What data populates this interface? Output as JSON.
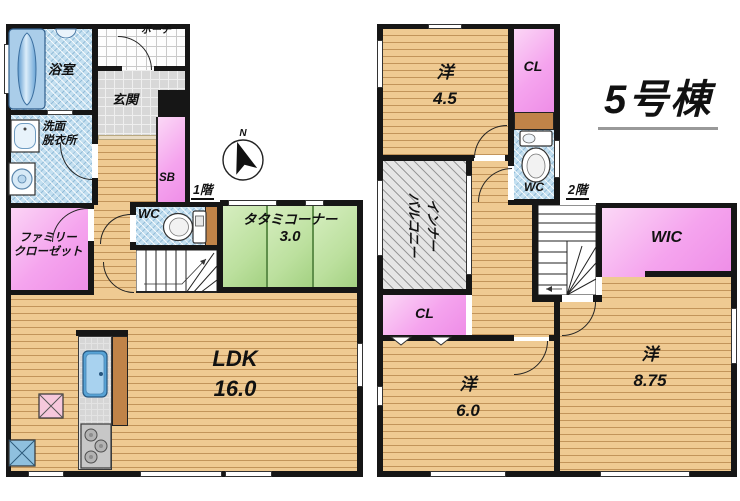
{
  "title": "5号棟",
  "compass": {
    "north": "N"
  },
  "floor1": {
    "label": "1階",
    "bathroom": "浴室",
    "porch": "ポーチ",
    "entrance": "玄関",
    "washroom": [
      "洗面",
      "脱衣所"
    ],
    "shoe_box": "SB",
    "toilet": "WC",
    "family_closet": [
      "ファミリー",
      "クローゼット"
    ],
    "tatami_corner": {
      "name": "タタミコーナー",
      "size": "3.0"
    },
    "ldk": {
      "name": "LDK",
      "size": "16.0"
    }
  },
  "floor2": {
    "label": "2階",
    "bedroom_45": {
      "name": "洋",
      "size": "4.5"
    },
    "closet_upper": "CL",
    "toilet": "WC",
    "inner_balcony": [
      "インナー",
      "バルコニー"
    ],
    "closet_lower": "CL",
    "walk_in_closet": "WIC",
    "bedroom_60": {
      "name": "洋",
      "size": "6.0"
    },
    "bedroom_875": {
      "name": "洋",
      "size": "8.75"
    }
  },
  "colors": {
    "wood_floor": "#EFCA92",
    "wood_plank_line": "#C2945A",
    "wall": "#161616",
    "closet_pink": "#F5A4EE",
    "tatami_green": "#BCE09E",
    "wet_area_blue": "#C3DFF0",
    "entrance_tile_gray": "#D8D8D8",
    "balcony_hatch_gray": "#E5E5E5",
    "fixture_blue": "#9CC6E4",
    "cabinet_brown": "#C08348"
  }
}
